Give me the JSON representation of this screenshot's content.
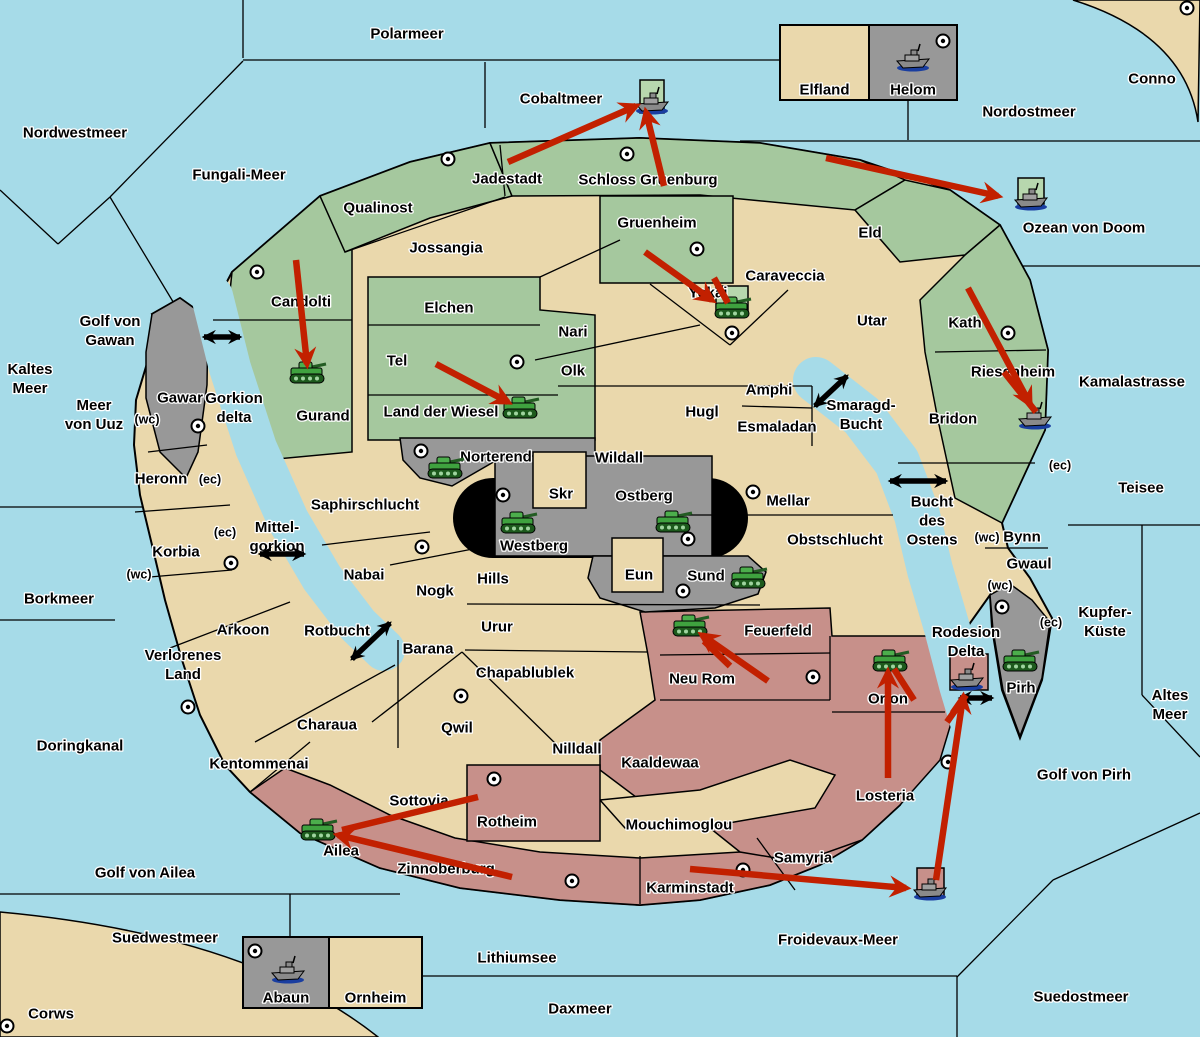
{
  "map": {
    "title": "strategy-game-map",
    "width": 1200,
    "height": 1037
  },
  "colors": {
    "water": "#A6DBE8",
    "land": "#EAD8AC",
    "green": "#A5C89E",
    "gray": "#989898",
    "pink": "#C7908A",
    "box_green": "#B7D7AE",
    "black": "#000000",
    "red_arrow": "#C22000",
    "label": "#000000",
    "halo": "#FFFFFF",
    "tank_body": "#3FA23F",
    "tank_track": "#1D5A1D",
    "ship_hull": "#8A8A8A",
    "ship_keel": "#1A3EA0"
  },
  "sea_labels": [
    {
      "t": "Polarmeer",
      "x": 407,
      "y": 33
    },
    {
      "t": "Nordwestmeer",
      "x": 75,
      "y": 132
    },
    {
      "t": "Fungali-Meer",
      "x": 239,
      "y": 174
    },
    {
      "t": "Cobaltmeer",
      "x": 561,
      "y": 98
    },
    {
      "t": "Nordostmeer",
      "x": 1029,
      "y": 111
    },
    {
      "t": "Conno",
      "x": 1152,
      "y": 78
    },
    {
      "t": "Ozean von Doom",
      "x": 1084,
      "y": 227
    },
    {
      "t": "Kaltes\nMeer",
      "x": 30,
      "y": 378
    },
    {
      "t": "Golf von\nGawan",
      "x": 110,
      "y": 330
    },
    {
      "t": "Meer\nvon Uuz",
      "x": 94,
      "y": 414
    },
    {
      "t": "Gorkion\ndelta",
      "x": 234,
      "y": 407
    },
    {
      "t": "Mittel-\ngorkion",
      "x": 277,
      "y": 536
    },
    {
      "t": "Borkmeer",
      "x": 59,
      "y": 598
    },
    {
      "t": "Doringkanal",
      "x": 80,
      "y": 745
    },
    {
      "t": "Rotbucht",
      "x": 337,
      "y": 630
    },
    {
      "t": "Golf von Ailea",
      "x": 145,
      "y": 872
    },
    {
      "t": "Suedwestmeer",
      "x": 165,
      "y": 937
    },
    {
      "t": "Corws",
      "x": 51,
      "y": 1013
    },
    {
      "t": "Lithiumsee",
      "x": 517,
      "y": 957
    },
    {
      "t": "Daxmeer",
      "x": 580,
      "y": 1008
    },
    {
      "t": "Froidevaux-Meer",
      "x": 838,
      "y": 939
    },
    {
      "t": "Suedostmeer",
      "x": 1081,
      "y": 996
    },
    {
      "t": "Golf von Pirh",
      "x": 1084,
      "y": 774
    },
    {
      "t": "Altes\nMeer",
      "x": 1170,
      "y": 704
    },
    {
      "t": "Kupfer-\nKüste",
      "x": 1105,
      "y": 621
    },
    {
      "t": "Teisee",
      "x": 1141,
      "y": 487
    },
    {
      "t": "Kamalastrasse",
      "x": 1132,
      "y": 381
    },
    {
      "t": "Smaragd-\nBucht",
      "x": 861,
      "y": 414
    },
    {
      "t": "Bucht\ndes\nOstens",
      "x": 932,
      "y": 520
    }
  ],
  "land_labels": [
    {
      "t": "Jadestadt",
      "x": 507,
      "y": 178
    },
    {
      "t": "Schloss Gruenburg",
      "x": 648,
      "y": 179
    },
    {
      "t": "Qualinost",
      "x": 378,
      "y": 207
    },
    {
      "t": "Jossangia",
      "x": 446,
      "y": 247
    },
    {
      "t": "Candolti",
      "x": 301,
      "y": 301
    },
    {
      "t": "Elchen",
      "x": 449,
      "y": 307
    },
    {
      "t": "Tel",
      "x": 397,
      "y": 360
    },
    {
      "t": "Land der Wiesel",
      "x": 441,
      "y": 411
    },
    {
      "t": "Nari",
      "x": 573,
      "y": 331
    },
    {
      "t": "Olk",
      "x": 573,
      "y": 370
    },
    {
      "t": "Gruenheim",
      "x": 657,
      "y": 222
    },
    {
      "t": "Yokai",
      "x": 708,
      "y": 292
    },
    {
      "t": "Caraveccia",
      "x": 785,
      "y": 275
    },
    {
      "t": "Eld",
      "x": 870,
      "y": 232
    },
    {
      "t": "Utar",
      "x": 872,
      "y": 320
    },
    {
      "t": "Kath",
      "x": 965,
      "y": 322
    },
    {
      "t": "Riesenheim",
      "x": 1013,
      "y": 371
    },
    {
      "t": "Bridon",
      "x": 953,
      "y": 418
    },
    {
      "t": "Hugl",
      "x": 702,
      "y": 411
    },
    {
      "t": "Amphi",
      "x": 769,
      "y": 389
    },
    {
      "t": "Esmaladan",
      "x": 777,
      "y": 426
    },
    {
      "t": "Wildall",
      "x": 619,
      "y": 457
    },
    {
      "t": "Norterend",
      "x": 496,
      "y": 456
    },
    {
      "t": "Skr",
      "x": 561,
      "y": 493
    },
    {
      "t": "Ostberg",
      "x": 644,
      "y": 495
    },
    {
      "t": "Westberg",
      "x": 534,
      "y": 545
    },
    {
      "t": "Mellar",
      "x": 788,
      "y": 500
    },
    {
      "t": "Eun",
      "x": 639,
      "y": 574
    },
    {
      "t": "Sund",
      "x": 706,
      "y": 575
    },
    {
      "t": "Obstschlucht",
      "x": 835,
      "y": 539
    },
    {
      "t": "Saphirschlucht",
      "x": 365,
      "y": 504
    },
    {
      "t": "Heronn",
      "x": 161,
      "y": 478
    },
    {
      "t": "Korbia",
      "x": 176,
      "y": 551
    },
    {
      "t": "Nabai",
      "x": 364,
      "y": 574
    },
    {
      "t": "Nogk",
      "x": 435,
      "y": 590
    },
    {
      "t": "Hills",
      "x": 493,
      "y": 578
    },
    {
      "t": "Urur",
      "x": 497,
      "y": 626
    },
    {
      "t": "Barana",
      "x": 428,
      "y": 648
    },
    {
      "t": "Arkoon",
      "x": 243,
      "y": 629
    },
    {
      "t": "Verlorenes\nLand",
      "x": 183,
      "y": 664
    },
    {
      "t": "Chapablublek",
      "x": 525,
      "y": 672
    },
    {
      "t": "Qwil",
      "x": 457,
      "y": 727
    },
    {
      "t": "Charaua",
      "x": 327,
      "y": 724
    },
    {
      "t": "Kentommenai",
      "x": 259,
      "y": 763
    },
    {
      "t": "Nilldall",
      "x": 577,
      "y": 748
    },
    {
      "t": "Sottovia",
      "x": 419,
      "y": 800
    },
    {
      "t": "Rotheim",
      "x": 507,
      "y": 821
    },
    {
      "t": "Kaaldewaa",
      "x": 660,
      "y": 762
    },
    {
      "t": "Mouchimoglou",
      "x": 679,
      "y": 824
    },
    {
      "t": "Neu Rom",
      "x": 702,
      "y": 678
    },
    {
      "t": "Feuerfeld",
      "x": 778,
      "y": 630
    },
    {
      "t": "Orlon",
      "x": 888,
      "y": 698
    },
    {
      "t": "Losteria",
      "x": 885,
      "y": 795
    },
    {
      "t": "Samyria",
      "x": 803,
      "y": 857
    },
    {
      "t": "Zinnoberburg",
      "x": 446,
      "y": 868
    },
    {
      "t": "Karminstadt",
      "x": 690,
      "y": 887
    },
    {
      "t": "Ailea",
      "x": 341,
      "y": 850
    },
    {
      "t": "Gawar",
      "x": 180,
      "y": 397
    },
    {
      "t": "Gurand",
      "x": 323,
      "y": 415
    },
    {
      "t": "Pirh",
      "x": 1021,
      "y": 687
    },
    {
      "t": "Bynn",
      "x": 1022,
      "y": 536
    },
    {
      "t": "Gwaul",
      "x": 1029,
      "y": 563
    },
    {
      "t": "Rodesion\nDelta",
      "x": 966,
      "y": 641
    }
  ],
  "coast_labels": [
    {
      "t": "(wc)",
      "x": 147,
      "y": 419
    },
    {
      "t": "(ec)",
      "x": 210,
      "y": 479
    },
    {
      "t": "(ec)",
      "x": 225,
      "y": 532
    },
    {
      "t": "(wc)",
      "x": 139,
      "y": 574
    },
    {
      "t": "(ec)",
      "x": 1060,
      "y": 465
    },
    {
      "t": "(wc)",
      "x": 987,
      "y": 537
    },
    {
      "t": "(wc)",
      "x": 1000,
      "y": 585
    },
    {
      "t": "(ec)",
      "x": 1051,
      "y": 622
    }
  ],
  "supply_dots": [
    {
      "x": 448,
      "y": 159
    },
    {
      "x": 627,
      "y": 154
    },
    {
      "x": 697,
      "y": 249
    },
    {
      "x": 1187,
      "y": 8
    },
    {
      "x": 943,
      "y": 41
    },
    {
      "x": 257,
      "y": 272
    },
    {
      "x": 517,
      "y": 362
    },
    {
      "x": 732,
      "y": 333
    },
    {
      "x": 1008,
      "y": 333
    },
    {
      "x": 198,
      "y": 426
    },
    {
      "x": 421,
      "y": 451
    },
    {
      "x": 503,
      "y": 495
    },
    {
      "x": 688,
      "y": 539
    },
    {
      "x": 753,
      "y": 492
    },
    {
      "x": 683,
      "y": 591
    },
    {
      "x": 422,
      "y": 547
    },
    {
      "x": 461,
      "y": 696
    },
    {
      "x": 231,
      "y": 563
    },
    {
      "x": 188,
      "y": 707
    },
    {
      "x": 813,
      "y": 677
    },
    {
      "x": 948,
      "y": 762
    },
    {
      "x": 494,
      "y": 779
    },
    {
      "x": 572,
      "y": 881
    },
    {
      "x": 743,
      "y": 870
    },
    {
      "x": 1002,
      "y": 607
    },
    {
      "x": 7,
      "y": 1026
    },
    {
      "x": 255,
      "y": 951
    }
  ],
  "tanks": [
    {
      "x": 307,
      "y": 375
    },
    {
      "x": 520,
      "y": 410
    },
    {
      "x": 445,
      "y": 470
    },
    {
      "x": 518,
      "y": 525
    },
    {
      "x": 673,
      "y": 524
    },
    {
      "x": 748,
      "y": 580
    },
    {
      "x": 732,
      "y": 310
    },
    {
      "x": 690,
      "y": 628
    },
    {
      "x": 890,
      "y": 663
    },
    {
      "x": 1020,
      "y": 663
    },
    {
      "x": 318,
      "y": 832
    }
  ],
  "ships": [
    {
      "x": 652,
      "y": 103
    },
    {
      "x": 1031,
      "y": 199
    },
    {
      "x": 913,
      "y": 60
    },
    {
      "x": 1035,
      "y": 418
    },
    {
      "x": 967,
      "y": 679
    },
    {
      "x": 930,
      "y": 889
    },
    {
      "x": 288,
      "y": 972
    }
  ],
  "unit_boxes": [
    {
      "x": 640,
      "y": 80,
      "w": 24,
      "h": 33,
      "fill": "box_green"
    },
    {
      "x": 1018,
      "y": 178,
      "w": 26,
      "h": 26,
      "fill": "box_green"
    },
    {
      "x": 716,
      "y": 286,
      "w": 32,
      "h": 26,
      "fill": "box_green"
    },
    {
      "x": 950,
      "y": 654,
      "w": 38,
      "h": 36,
      "fill": "pink"
    },
    {
      "x": 917,
      "y": 868,
      "w": 27,
      "h": 28,
      "fill": "pink"
    }
  ],
  "legend": [
    {
      "x": 780,
      "y": 25,
      "w": 177,
      "h": 75,
      "cells": [
        {
          "label": "Elfland",
          "fill": "land",
          "w": 89
        },
        {
          "label": "Helom",
          "fill": "gray",
          "w": 88
        }
      ]
    },
    {
      "x": 243,
      "y": 937,
      "w": 179,
      "h": 71,
      "cells": [
        {
          "label": "Abaun",
          "fill": "gray",
          "w": 86
        },
        {
          "label": "Ornheim",
          "fill": "land",
          "w": 93
        }
      ]
    }
  ],
  "black_arrows": [
    {
      "x1": 204,
      "y1": 337,
      "x2": 240,
      "y2": 337
    },
    {
      "x1": 260,
      "y1": 554,
      "x2": 304,
      "y2": 554
    },
    {
      "x1": 352,
      "y1": 659,
      "x2": 390,
      "y2": 623
    },
    {
      "x1": 815,
      "y1": 406,
      "x2": 847,
      "y2": 376
    },
    {
      "x1": 890,
      "y1": 481,
      "x2": 946,
      "y2": 481
    },
    {
      "x1": 960,
      "y1": 698,
      "x2": 992,
      "y2": 698
    }
  ],
  "red_arrows": [
    {
      "x1": 508,
      "y1": 162,
      "x2": 636,
      "y2": 106,
      "head": true
    },
    {
      "x1": 664,
      "y1": 186,
      "x2": 646,
      "y2": 112,
      "head": true
    },
    {
      "x1": 826,
      "y1": 158,
      "x2": 998,
      "y2": 196,
      "head": true
    },
    {
      "x1": 296,
      "y1": 260,
      "x2": 307,
      "y2": 364,
      "head": true
    },
    {
      "x1": 436,
      "y1": 364,
      "x2": 508,
      "y2": 402,
      "head": true
    },
    {
      "x1": 645,
      "y1": 252,
      "x2": 712,
      "y2": 300,
      "head": true
    },
    {
      "x1": 714,
      "y1": 278,
      "x2": 728,
      "y2": 303,
      "head": false
    },
    {
      "x1": 968,
      "y1": 288,
      "x2": 1030,
      "y2": 404,
      "head": true
    },
    {
      "x1": 1004,
      "y1": 372,
      "x2": 1036,
      "y2": 412,
      "head": false
    },
    {
      "x1": 768,
      "y1": 681,
      "x2": 702,
      "y2": 635,
      "head": true
    },
    {
      "x1": 730,
      "y1": 666,
      "x2": 704,
      "y2": 641,
      "head": false
    },
    {
      "x1": 888,
      "y1": 778,
      "x2": 888,
      "y2": 672,
      "head": true
    },
    {
      "x1": 914,
      "y1": 700,
      "x2": 894,
      "y2": 669,
      "head": false
    },
    {
      "x1": 690,
      "y1": 869,
      "x2": 906,
      "y2": 888,
      "head": true
    },
    {
      "x1": 936,
      "y1": 880,
      "x2": 963,
      "y2": 697,
      "head": true
    },
    {
      "x1": 947,
      "y1": 722,
      "x2": 966,
      "y2": 695,
      "head": false
    },
    {
      "x1": 512,
      "y1": 877,
      "x2": 338,
      "y2": 835,
      "head": true
    },
    {
      "x1": 478,
      "y1": 797,
      "x2": 342,
      "y2": 830,
      "head": false
    }
  ]
}
